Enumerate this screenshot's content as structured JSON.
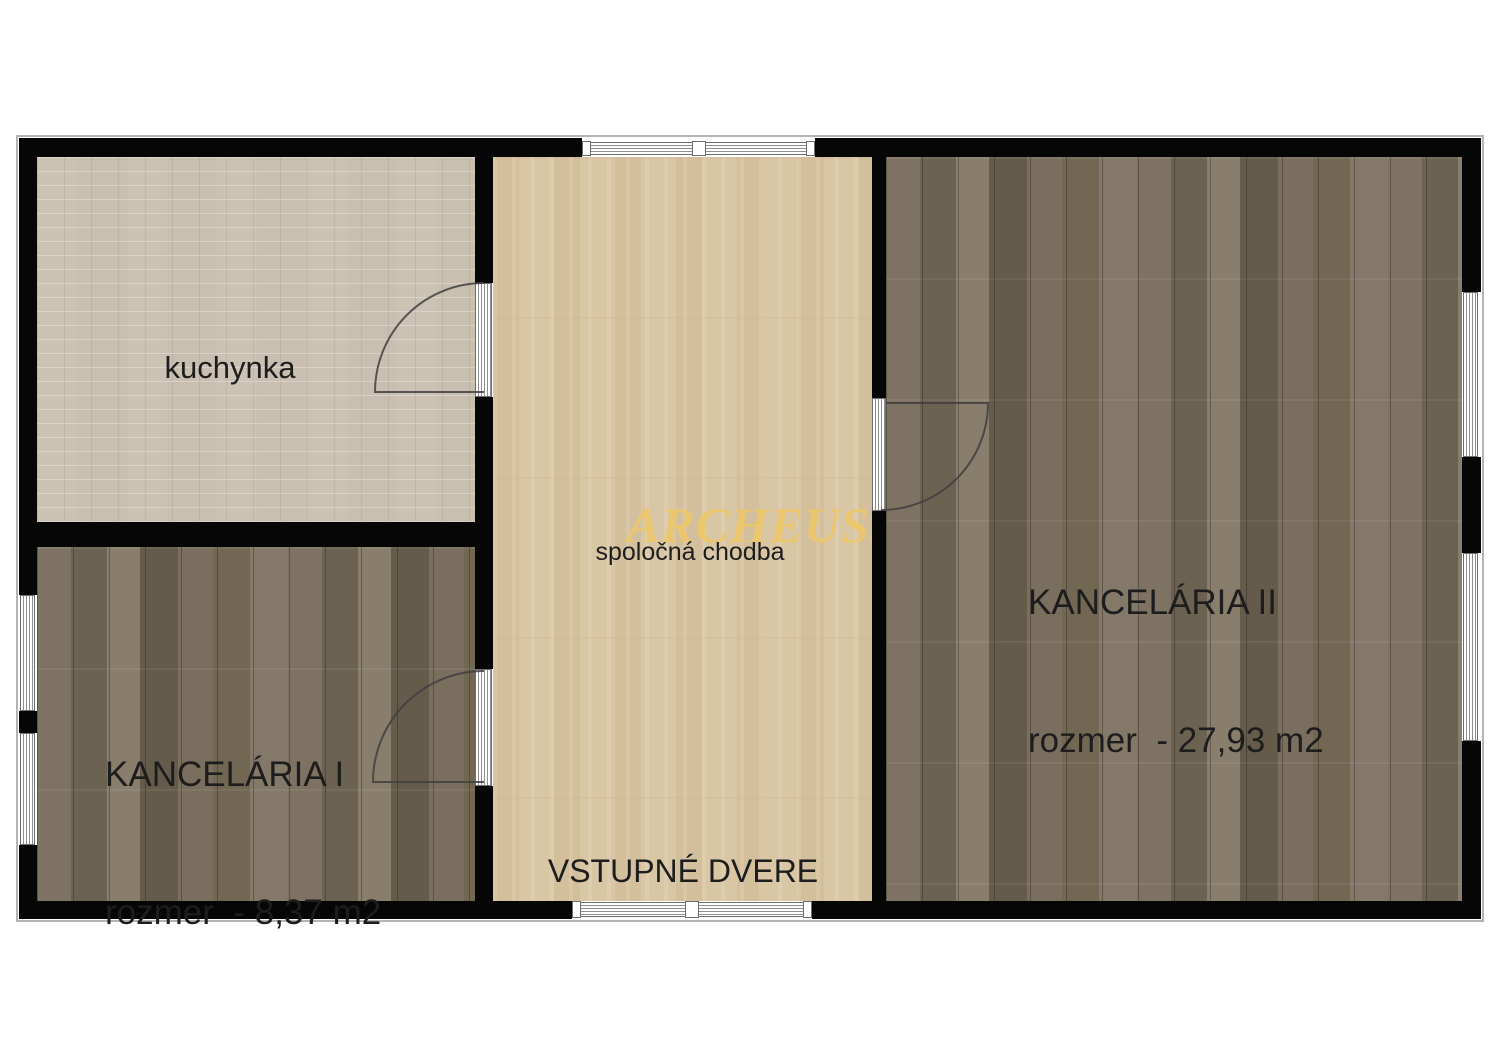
{
  "watermark": "ARCHEUS.",
  "rooms": {
    "kitchen": {
      "label": "kuchynka"
    },
    "hallway": {
      "label": "spoločná chodba"
    },
    "office1": {
      "name": "KANCELÁRIA I",
      "size": "rozmer  - 8,37 m2"
    },
    "office2": {
      "name": "KANCELÁRIA II",
      "size": "rozmer  - 27,93 m2"
    }
  },
  "entrance": {
    "label": "VSTUPNÉ DVERE"
  },
  "colors": {
    "wall": "#060606",
    "kitchen_floor": "#c8bfb0",
    "hallway_floor": "#d9c6a5",
    "office_floor": "#73695a",
    "watermark": "#ebc76a",
    "text": "#1d1d1d",
    "symbol_line": "#6e6e6e"
  }
}
